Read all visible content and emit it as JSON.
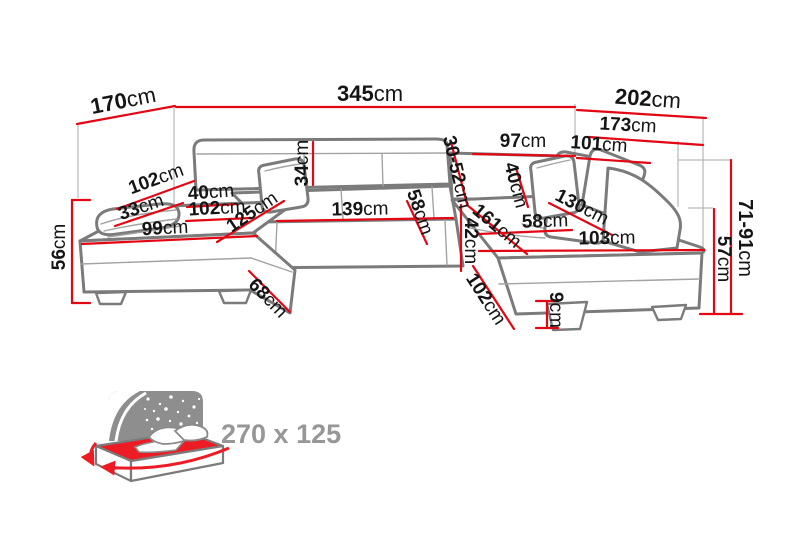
{
  "unit_suffix": "cm",
  "colors": {
    "dimension_line": "#e30613",
    "sofa_outline": "#7b7b7b",
    "label_text": "#151515",
    "bed_accent_red": "#ed1c24",
    "icon_gray": "#8e8e8e",
    "sleeping_label_gray": "#979797",
    "background": "#ffffff"
  },
  "dimensions": [
    {
      "id": "total-width",
      "value": "345",
      "unit": "cm"
    },
    {
      "id": "left-side-depth",
      "value": "170",
      "unit": "cm"
    },
    {
      "id": "right-side-depth",
      "value": "202",
      "unit": "cm"
    },
    {
      "id": "right-back-width",
      "value": "173",
      "unit": "cm"
    },
    {
      "id": "right-inner-width",
      "value": "101",
      "unit": "cm"
    },
    {
      "id": "back-section-width",
      "value": "97",
      "unit": "cm"
    },
    {
      "id": "headrest-range",
      "value": "30-52",
      "unit": "cm"
    },
    {
      "id": "backrest-height",
      "value": "34",
      "unit": "cm"
    },
    {
      "id": "left-chaise-length",
      "value": "102",
      "unit": "cm"
    },
    {
      "id": "left-armrest-width",
      "value": "33",
      "unit": "cm"
    },
    {
      "id": "left-pillow-width",
      "value": "40",
      "unit": "cm"
    },
    {
      "id": "left-seat-width",
      "value": "102",
      "unit": "cm"
    },
    {
      "id": "left-front-width",
      "value": "99",
      "unit": "cm"
    },
    {
      "id": "left-seat-depth",
      "value": "125",
      "unit": "cm"
    },
    {
      "id": "left-arm-height",
      "value": "56",
      "unit": "cm"
    },
    {
      "id": "middle-seat-width",
      "value": "139",
      "unit": "cm"
    },
    {
      "id": "middle-seat-depth",
      "value": "58",
      "unit": "cm"
    },
    {
      "id": "seat-front-height",
      "value": "42",
      "unit": "cm"
    },
    {
      "id": "right-chaise-length",
      "value": "161",
      "unit": "cm"
    },
    {
      "id": "right-pillow-width",
      "value": "40",
      "unit": "cm"
    },
    {
      "id": "right-backrest-width",
      "value": "130",
      "unit": "cm"
    },
    {
      "id": "right-seat-width",
      "value": "58",
      "unit": "cm"
    },
    {
      "id": "right-front-width",
      "value": "103",
      "unit": "cm"
    },
    {
      "id": "adjustable-back-height",
      "value": "71-91",
      "unit": "cm"
    },
    {
      "id": "platform-height",
      "value": "57",
      "unit": "cm"
    },
    {
      "id": "left-corner-edge",
      "value": "68",
      "unit": "cm"
    },
    {
      "id": "right-corner-edge",
      "value": "102",
      "unit": "cm"
    },
    {
      "id": "leg-height",
      "value": "9",
      "unit": "cm"
    }
  ],
  "sleeping_area": {
    "label": "270 x 125",
    "icon": "sofa-bed-icon"
  }
}
